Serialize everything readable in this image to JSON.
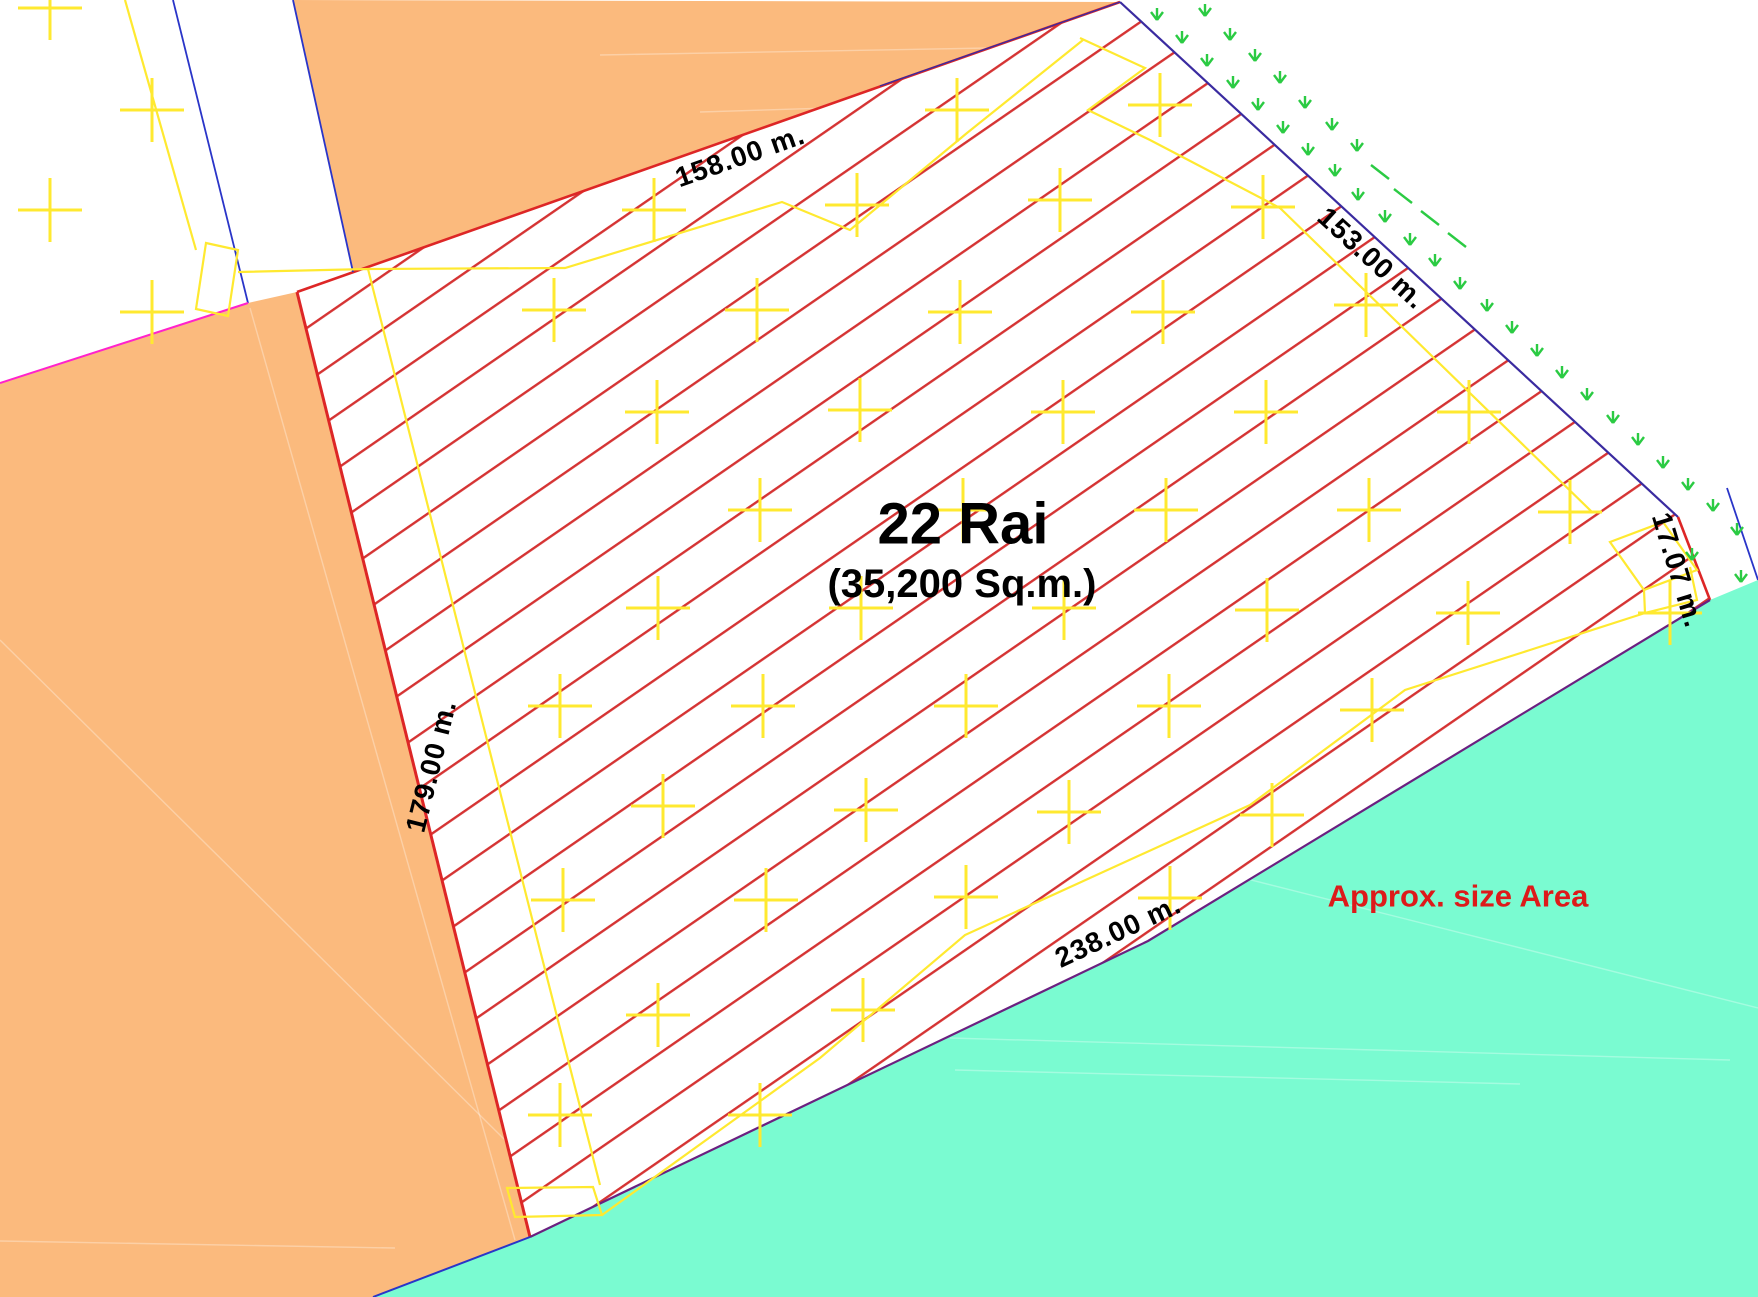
{
  "plot": {
    "area_title": "22 Rai",
    "area_subtitle": "(35,200 Sq.m.)",
    "dimensions": {
      "top": "158.00 m.",
      "northeast": "153.00 m.",
      "east": "17.07 m.",
      "west": "179.00 m.",
      "south": "238.00 m."
    }
  },
  "annotation": {
    "note": "Approx. size Area"
  },
  "colors": {
    "orange": "#FBBA7D",
    "teal": "#7AFBD1",
    "hatch": "#D53333",
    "boundary_red": "#DD2626",
    "yellow": "#FFE930",
    "navy": "#3A2BA0",
    "blue": "#2A35C8",
    "magenta": "#FF22CC",
    "purple": "#6B2080",
    "green": "#2BCB43",
    "note_red": "#DD1A1A",
    "label_black": "#000000"
  }
}
